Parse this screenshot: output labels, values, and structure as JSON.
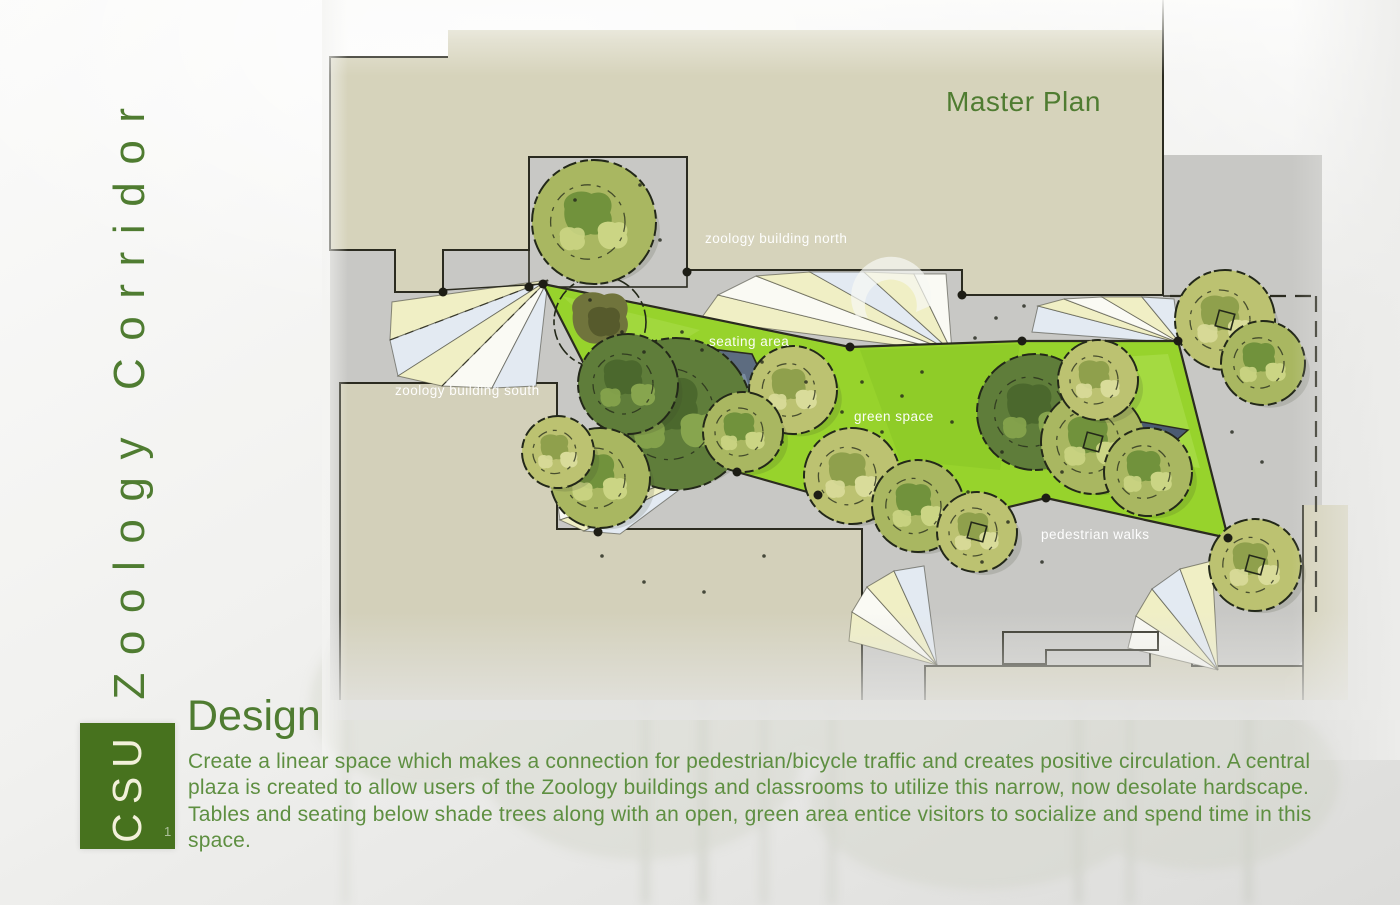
{
  "page": {
    "vertical_title": "Zoology Corridor",
    "logo_text": "CSU",
    "page_number": "1"
  },
  "plan": {
    "title": "Master Plan",
    "labels": {
      "building_north": "zoology building north",
      "seating": "seating area",
      "building_south": "zoology building south",
      "green_space": "green space",
      "walks": "pedestrian walks"
    }
  },
  "design": {
    "heading": "Design",
    "body": "Create a linear space which makes a connection for pedestrian/bicycle traffic and creates positive circulation. A central plaza is created to allow users of the Zoology buildings and classrooms to utilize this narrow, now desolate hardscape. Tables and seating below shade trees along with an open, green area entice visitors to socialize and spend time in this space."
  },
  "colors": {
    "accent_green": "#4f7c31",
    "logo_green": "#47721e",
    "lime_green": "#97d32c",
    "building_tan": "#d6d3bb",
    "pavement_gray": "#c8c8c5",
    "plaza_slate": "#5d6c80",
    "label_white": "#ffffff"
  }
}
